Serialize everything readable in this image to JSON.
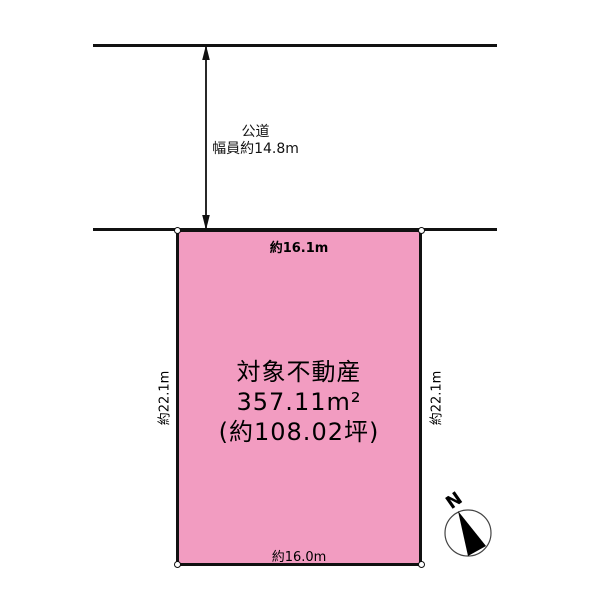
{
  "diagram_title": "site-plan",
  "road": {
    "name": "公道",
    "width_label": "幅員約14.8m"
  },
  "parcel": {
    "title": "対象不動産",
    "area_m2": "357.11m²",
    "area_tsubo": "(約108.02坪)",
    "dim_top": "約16.1m",
    "dim_bottom": "約16.0m",
    "dim_left": "約22.1m",
    "dim_right": "約22.1m"
  },
  "compass": {
    "label": "N"
  },
  "colors": {
    "parcel_fill": "#F29CC1",
    "line": "#111111",
    "background": "#FFFFFF"
  }
}
